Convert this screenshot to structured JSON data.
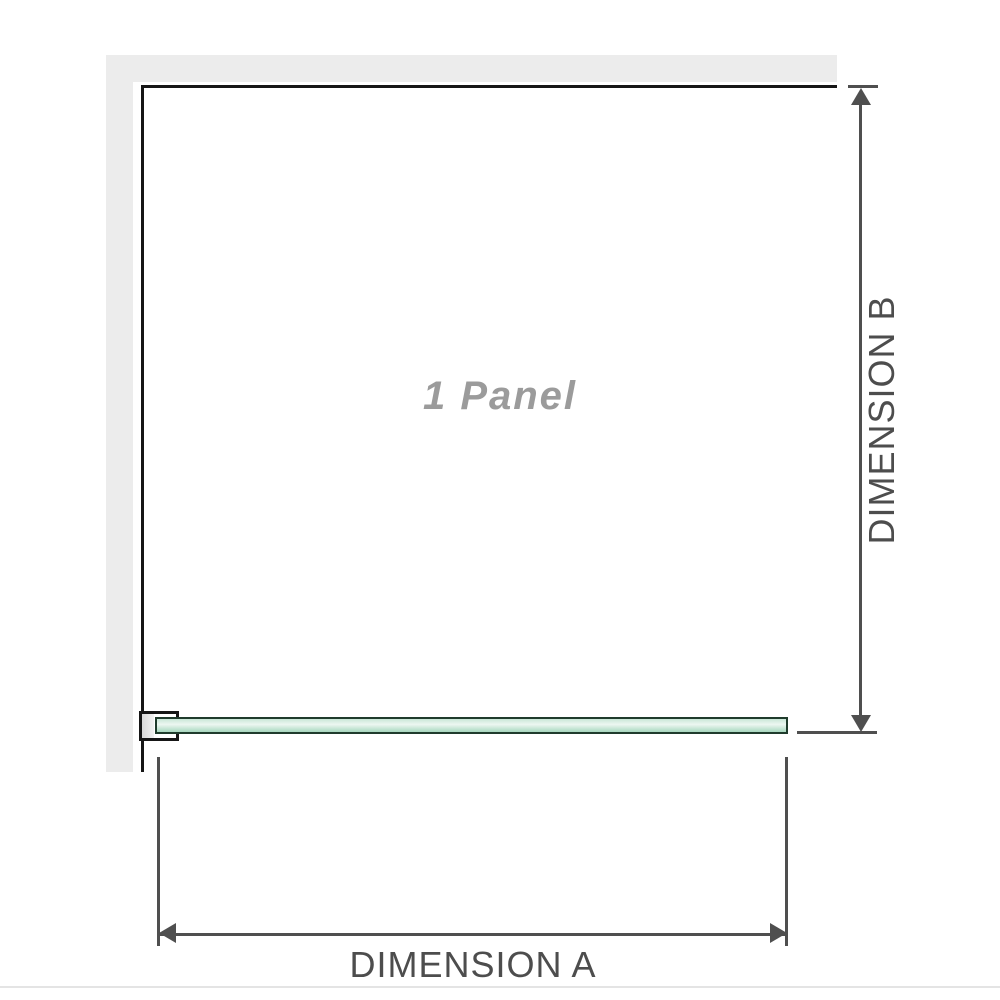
{
  "diagram": {
    "panel_label": "1 Panel",
    "dimensions": {
      "a": {
        "label": "DIMENSION A"
      },
      "b": {
        "label": "DIMENSION B"
      }
    },
    "icons": {
      "vertical_dimension": [
        "arrow-up-icon",
        "arrow-down-icon"
      ],
      "horizontal_dimension": [
        "arrow-left-icon",
        "arrow-right-icon"
      ]
    },
    "colors": {
      "background": "#ffffff",
      "wall_fill": "#ececec",
      "wall_edge": "#161616",
      "dimension_line": "#4f4f4f",
      "dimension_text": "#4d4d4d",
      "panel_label_text": "#9b9b9b",
      "glass_outline": "#1f3b2c",
      "glass_top": "#c9e7d7",
      "glass_highlight": "#edf7f1",
      "glass_bottom": "#a7d7be",
      "divider": "#e4e4e4"
    }
  }
}
